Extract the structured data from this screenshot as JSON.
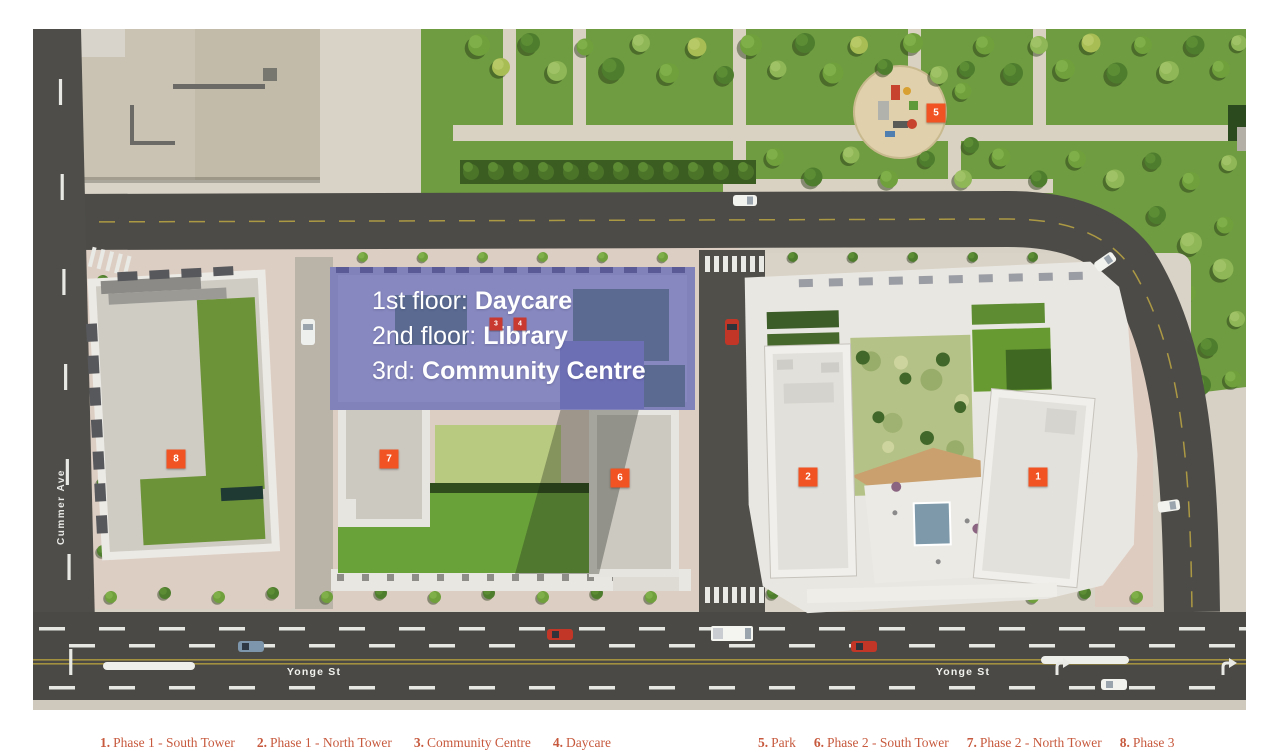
{
  "site_plan": {
    "streets": {
      "cummer": "Cummer Ave",
      "yonge_left": "Yonge St",
      "yonge_right": "Yonge St"
    },
    "overlay": {
      "lines": [
        {
          "prefix": "1st floor: ",
          "name": "Daycare"
        },
        {
          "prefix": "2nd floor: ",
          "name": "Library"
        },
        {
          "prefix": "3rd: ",
          "name": "Community Centre"
        }
      ]
    },
    "markers": {
      "m1": "1",
      "m2": "2",
      "m3": "3",
      "m4": "4",
      "m5": "5",
      "m6": "6",
      "m7": "7",
      "m8": "8"
    }
  },
  "legend": {
    "left": [
      {
        "num": "1.",
        "label": "Phase 1 - South Tower"
      },
      {
        "num": "2.",
        "label": "Phase 1 - North Tower"
      },
      {
        "num": "3.",
        "label": "Community Centre"
      },
      {
        "num": "4.",
        "label": "Daycare"
      }
    ],
    "right": [
      {
        "num": "5.",
        "label": "Park"
      },
      {
        "num": "6.",
        "label": "Phase 2 - South Tower"
      },
      {
        "num": "7.",
        "label": "Phase 2 - North Tower"
      },
      {
        "num": "8.",
        "label": "Phase 3"
      }
    ]
  },
  "colors": {
    "marker_orange": "#f15322",
    "marker_red_small": "#c9392f",
    "highlight_purple": "#7c7fc4",
    "legend_text": "#c75a3e",
    "road": "#4c4b47",
    "park_green": "#6f9c41"
  }
}
